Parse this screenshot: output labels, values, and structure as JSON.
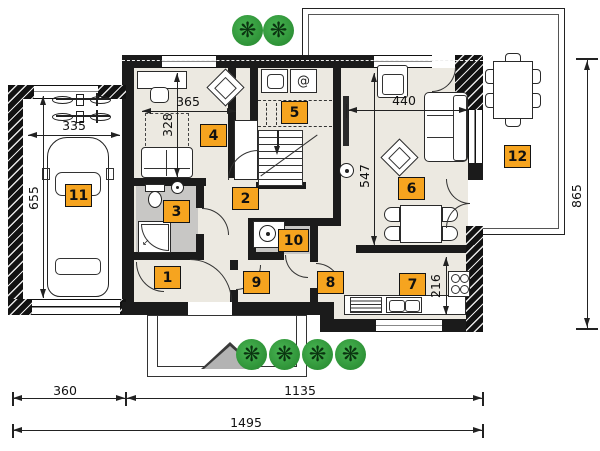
{
  "rooms": [
    {
      "label": "1"
    },
    {
      "label": "2"
    },
    {
      "label": "3"
    },
    {
      "label": "4"
    },
    {
      "label": "5"
    },
    {
      "label": "6"
    },
    {
      "label": "7"
    },
    {
      "label": "8"
    },
    {
      "label": "9"
    },
    {
      "label": "10"
    },
    {
      "label": "11"
    },
    {
      "label": "12"
    }
  ],
  "dims": {
    "garage_width": "335",
    "garage_depth": "655",
    "room4_width": "365",
    "room4_depth": "328",
    "living_width": "440",
    "living_depth": "547",
    "kitchen_depth": "216",
    "side_depth": "865",
    "plot_left": "360",
    "plot_right": "1135",
    "plot_total": "1495"
  },
  "icons": {
    "dryer_glyph": "@",
    "tree_glyph": "❋",
    "shower_arrow": "↙"
  },
  "colors": {
    "label_bg": "#f6a41f",
    "wall": "#1b1b1b",
    "bath_floor": "#c8c7c5",
    "room_floor": "#ece9e1",
    "tree_green": "#2e9237"
  }
}
